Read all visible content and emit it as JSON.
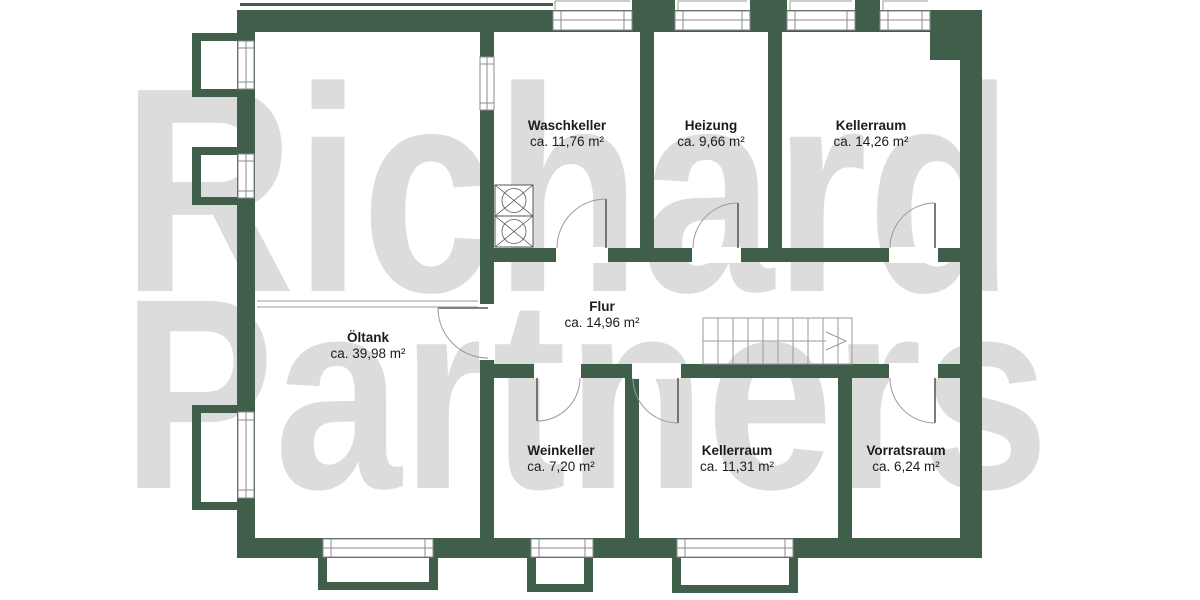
{
  "watermark": {
    "line1": "Richard",
    "line2": "Partners"
  },
  "colors": {
    "wall": "#3f5f4b",
    "watermark": "#dcdcdd",
    "text": "#1c1c1c",
    "symbol": "#9a9a9a"
  },
  "plan_type": "basement floor plan",
  "rooms": [
    {
      "name": "Waschkeller",
      "area": "ca. 11,76 m²"
    },
    {
      "name": "Heizung",
      "area": "ca. 9,66 m²"
    },
    {
      "name": "Kellerraum",
      "area": "ca. 14,26 m²"
    },
    {
      "name": "Öltank",
      "area": "ca. 39,98 m²"
    },
    {
      "name": "Flur",
      "area": "ca. 14,96 m²"
    },
    {
      "name": "Weinkeller",
      "area": "ca. 7,20 m²"
    },
    {
      "name": "Kellerraum",
      "area": "ca. 11,31 m²"
    },
    {
      "name": "Vorratsraum",
      "area": "ca. 6,24 m²"
    }
  ],
  "symbols": {
    "stairs": "stairs-icon",
    "washer": "washing-machine-icon",
    "door": "door-icon",
    "window": "window-icon",
    "light_well": "light-well"
  }
}
